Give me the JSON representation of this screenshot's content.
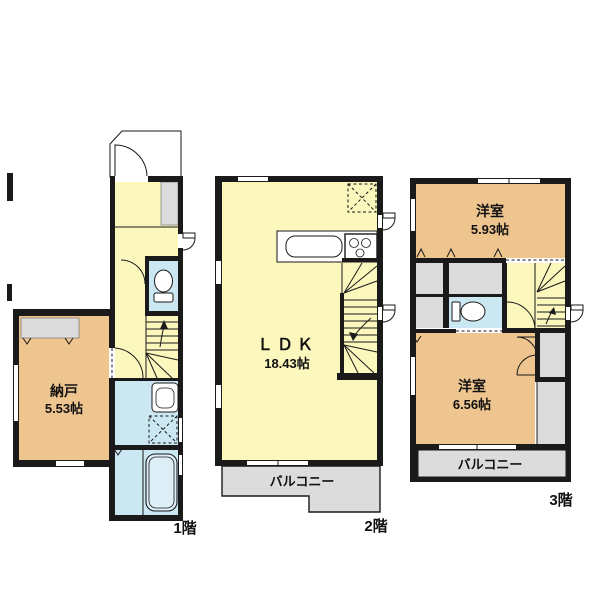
{
  "colors": {
    "wall": "#1a1a1a",
    "hall_yellow": "#fbf7bd",
    "room_tan": "#eec48f",
    "wet_blue": "#cbe7f2",
    "closet_gray": "#dbdbdb",
    "balcony_gray": "#dcdcdc"
  },
  "floors": [
    {
      "label": "1階",
      "rooms": [
        {
          "name": "納戸",
          "size": "5.53帖"
        }
      ]
    },
    {
      "label": "2階",
      "rooms": [
        {
          "name": "ＬＤＫ",
          "size": "18.43帖"
        }
      ],
      "balcony": "バルコニー"
    },
    {
      "label": "3階",
      "rooms": [
        {
          "name": "洋室",
          "size": "5.93帖"
        },
        {
          "name": "洋室",
          "size": "6.56帖"
        }
      ],
      "balcony": "バルコニー"
    }
  ]
}
